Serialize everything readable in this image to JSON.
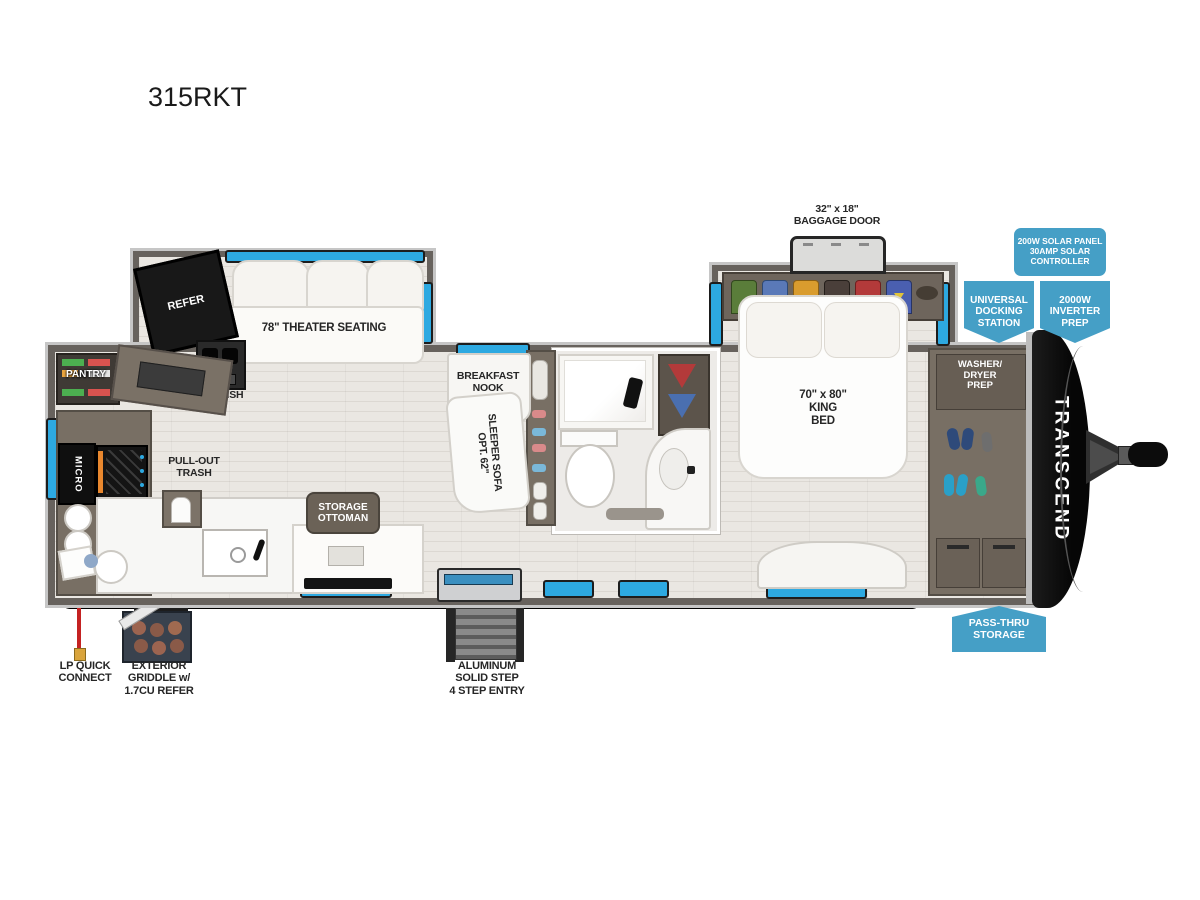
{
  "title": "315RKT",
  "colors": {
    "banner_blue": "#459fc6",
    "window_blue": "#2da9e1",
    "wall_gray": "#67625d",
    "cap_black": "#0d0d0d"
  },
  "callouts": {
    "solar": "200W SOLAR PANEL\n30AMP SOLAR\nCONTROLLER",
    "docking": "UNIVERSAL\nDOCKING\nSTATION",
    "inverter": "2000W\nINVERTER\nPREP",
    "passthru": "PASS-THRU\nSTORAGE"
  },
  "exterior": {
    "baggage_door": "32\" x 18\"\nBAGGAGE DOOR",
    "awning": "21' AWNING",
    "steps": "ALUMINUM\nSOLID STEP\n4 STEP ENTRY",
    "lp": "LP QUICK\nCONNECT",
    "griddle": "EXTERIOR\nGRIDDLE w/\n1.7CU REFER",
    "brand": "TRANSCEND"
  },
  "rooms": {
    "refer": "REFER",
    "theater": "78\" THEATER SEATING",
    "pet_dish": "PET DISH",
    "pantry": "PANTRY",
    "micro": "MICRO",
    "trash": "PULL-OUT\nTRASH",
    "ottoman": "STORAGE\nOTTOMAN",
    "nook": "BREAKFAST\nNOOK",
    "sofa": "OPT. 62\"\nSLEEPER SOFA",
    "bed": "70\" x 80\"\nKING\nBED",
    "washer": "WASHER/\nDRYER\nPREP"
  }
}
